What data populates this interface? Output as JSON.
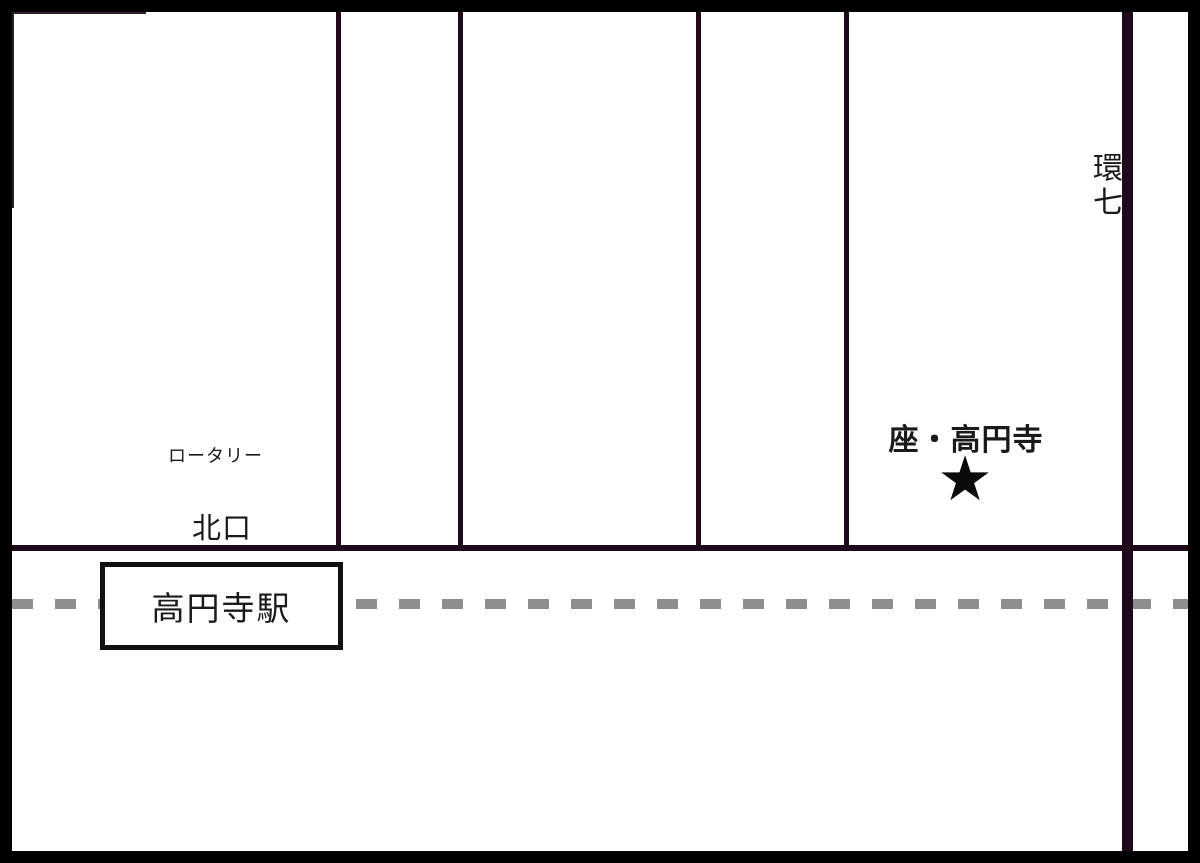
{
  "map": {
    "station": {
      "label": "高円寺駅"
    },
    "labels": {
      "rotary": "ロータリー",
      "north_exit": "北口",
      "venue": "座・高円寺",
      "ring_road": "環七"
    },
    "marker": {
      "glyph": "★"
    },
    "colors": {
      "road": "#1e0a1a",
      "thin_road": "#2c1c2c",
      "railway_dash": "#8e8e8e",
      "ink": "#1a1a1a",
      "border": "#000000",
      "background": "#ffffff"
    }
  }
}
